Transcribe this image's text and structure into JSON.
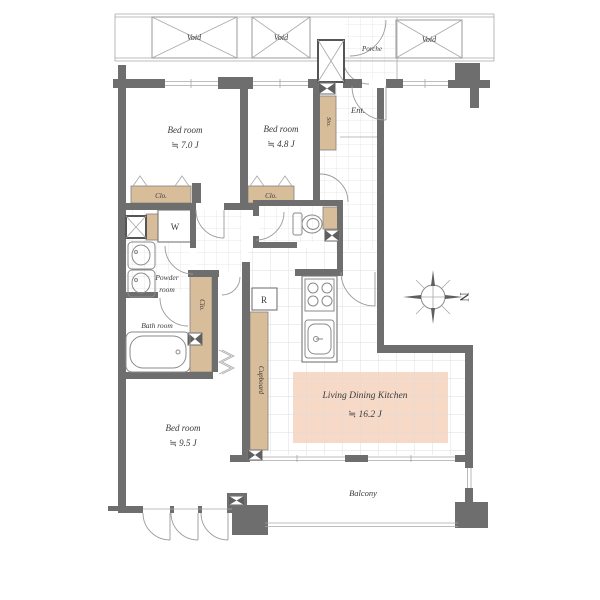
{
  "plan": {
    "voids": [
      "Void",
      "Void",
      "Void"
    ],
    "porch": "Porche",
    "entrance": "Ent.",
    "storage": "Sto.",
    "rooms": {
      "bedroom1": {
        "name": "Bed room",
        "area": "≒ 7.0 J"
      },
      "bedroom2": {
        "name": "Bed room",
        "area": "≒ 4.8 J"
      },
      "bedroom3": {
        "name": "Bed room",
        "area": "≒ 9.5 J"
      },
      "ldk": {
        "name": "Living Dining Kitchen",
        "area": "≒ 16.2 J"
      },
      "powder_room": {
        "line1": "Powder",
        "line2": "room"
      },
      "bath_room": "Bath room",
      "balcony": "Balcony"
    },
    "fixtures": {
      "closet1": "Clo.",
      "closet2": "Clo.",
      "closet3": "Clo.",
      "washer": "W",
      "refrigerator": "R",
      "cupboard": "Cupboard"
    },
    "compass": {
      "north": "N"
    },
    "colors": {
      "wall": "#6e6e6e",
      "fixture": "#d8bd9a",
      "highlight": "#f6d9c7",
      "line": "#9a9a9a"
    }
  }
}
